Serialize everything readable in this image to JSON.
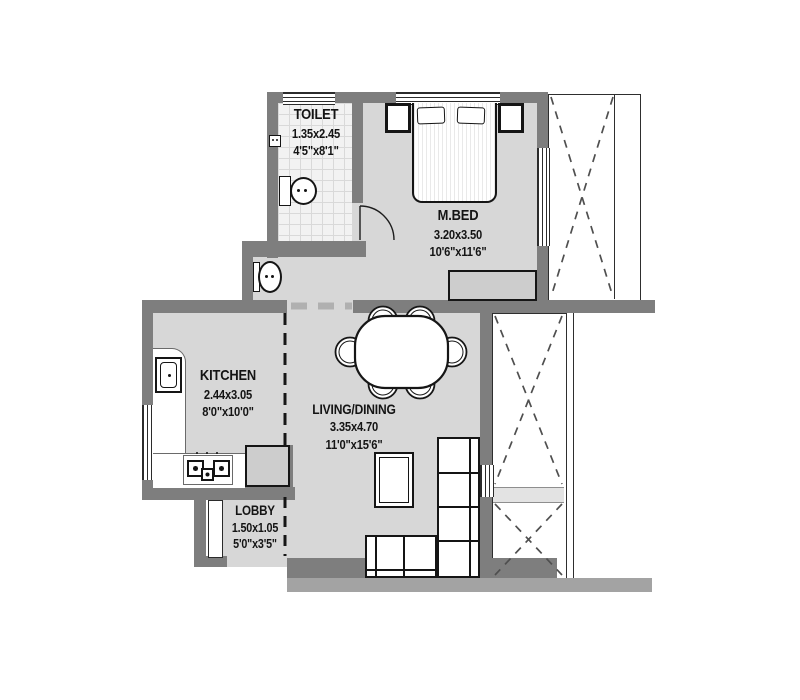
{
  "plan": {
    "title": "apartment-floor-plan",
    "colors": {
      "wall": "#7e7e7e",
      "floor": "#d7d7d7",
      "tile": "#f2f2f2",
      "void_hatch": "#4f4f4f",
      "furniture_line": "#151515"
    },
    "rooms": {
      "toilet": {
        "name": "TOILET",
        "dim_m": "1.35x2.45",
        "dim_ft": "4'5\"x8'1\""
      },
      "master_bedroom": {
        "name": "M.BED",
        "dim_m": "3.20x3.50",
        "dim_ft": "10'6\"x11'6\""
      },
      "kitchen": {
        "name": "KITCHEN",
        "dim_m": "2.44x3.05",
        "dim_ft": "8'0\"x10'0\""
      },
      "living_dining": {
        "name": "LIVING/DINING",
        "dim_m": "3.35x4.70",
        "dim_ft": "11'0\"x15'6\""
      },
      "lobby": {
        "name": "LOBBY",
        "dim_m": "1.50x1.05",
        "dim_ft": "5'0\"x3'5\""
      }
    }
  }
}
